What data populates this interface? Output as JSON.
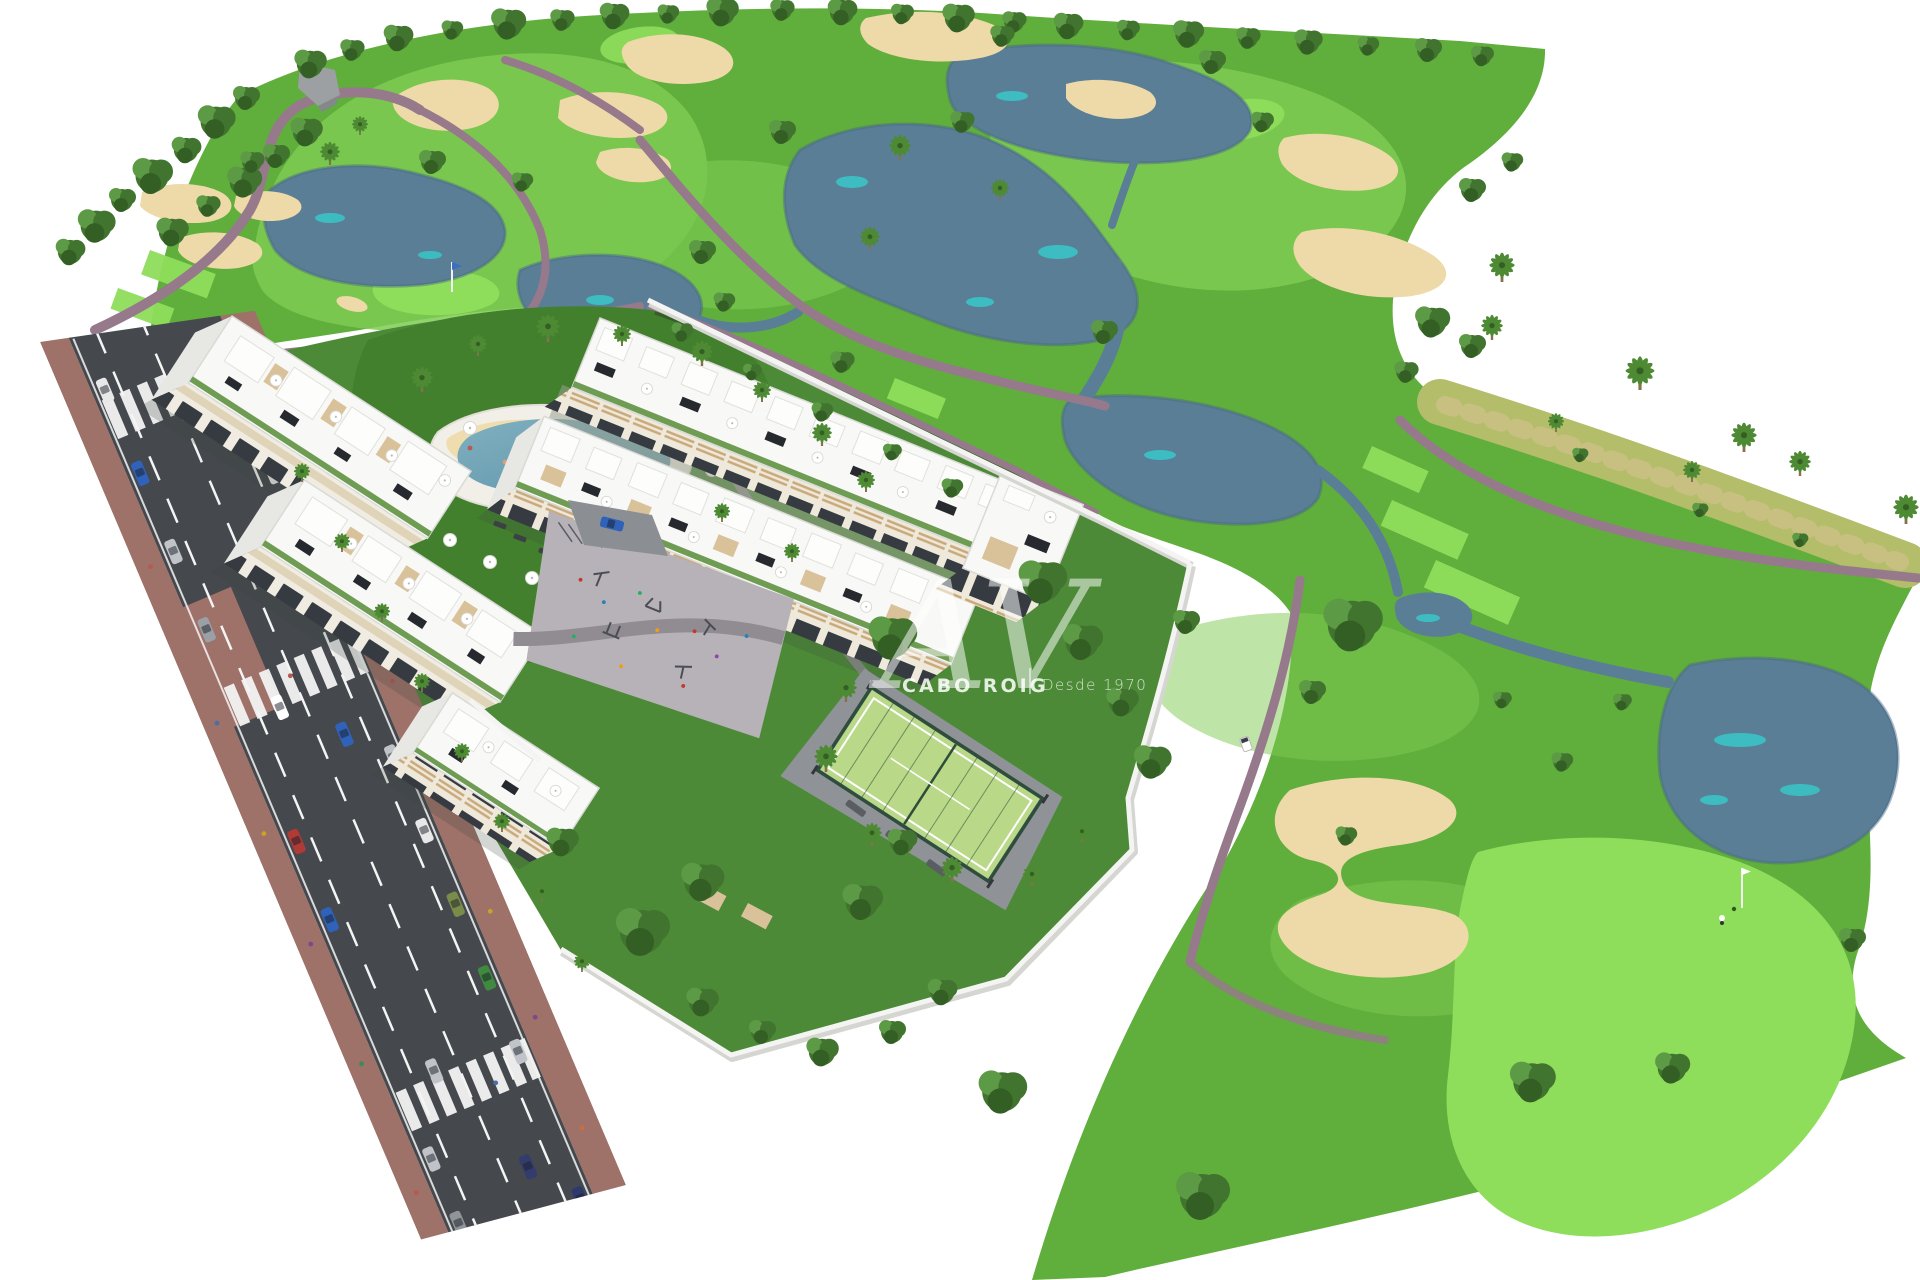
{
  "watermark": {
    "logo_monogram": "AV",
    "brand": "CABO ROIG",
    "tagline": "Desde 1970"
  },
  "palette": {
    "bg": "#ffffff",
    "grass": "#60ae3c",
    "grass_dark": "#549f35",
    "fairway": "#7ecc52",
    "green_bright": "#8fde5b",
    "garden": "#4d8a37",
    "lawn": "#43802e",
    "dry_grass": "#b3bd6a",
    "dry_speckle": "#d2c28c",
    "lake": "#5b7e97",
    "lake_deep": "#466884",
    "teal": "#38c7c8",
    "sand": "#eedaa8",
    "path": "#97798c",
    "road": "#45494e",
    "road_mark": "#f4f4f4",
    "sidewalk": "#9e7169",
    "plaza": "#b6b2b7",
    "plaza_path": "#908c92",
    "wall": "#f4f4f2",
    "wall_shadow": "#d5d5d2",
    "building": "#f8f8f6",
    "building_edge": "#d9d9d6",
    "facade_bg": "#f0ece2",
    "glass": "#363b41",
    "wood": "#c9a979",
    "beige_band": "#dfd3b8",
    "roof_garden": "#6f9c53",
    "panel_dark": "#26292e",
    "terrace_tan": "#d9c29a",
    "pool_water": "#7fb0c0",
    "pool_deep": "#5e93a8",
    "pool_deck": "#f1efe8",
    "court_green": "#b9d989",
    "court_fence": "#2e4d3a",
    "court_apron": "#8f9398",
    "tree1": "#41742e",
    "tree2": "#5d9a45",
    "tree3": "#335e24",
    "palm": "#4d8a33",
    "trunk": "#8a6f4e",
    "rock": "#9da0a2",
    "flag_blue": "#3a6fc4"
  }
}
